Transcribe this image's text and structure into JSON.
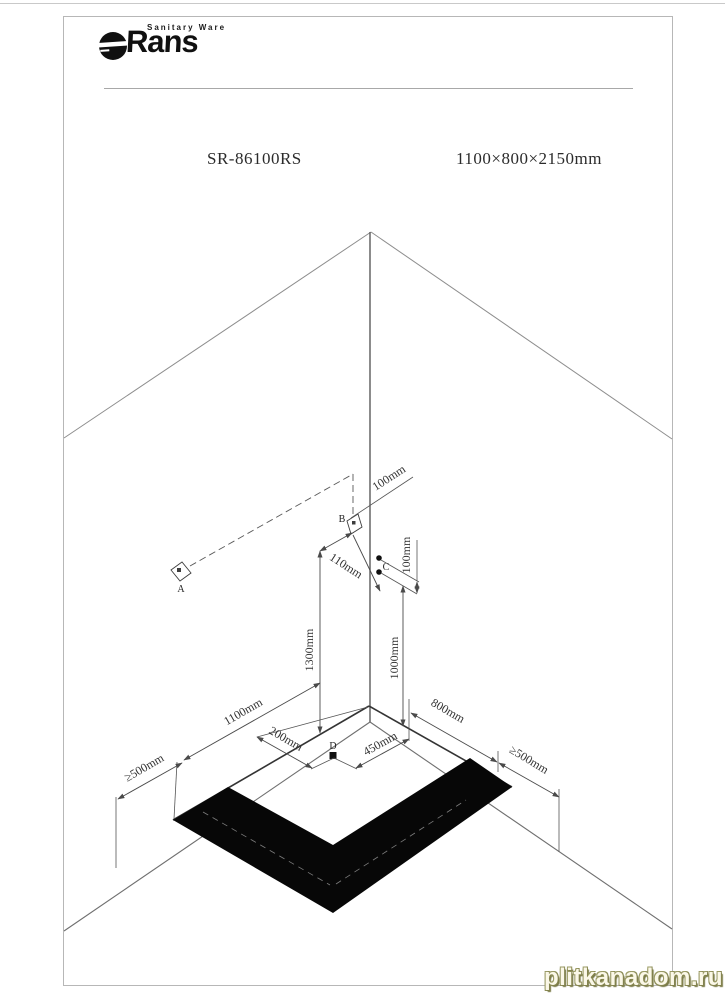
{
  "header": {
    "logo_small_text": "Sanitary Ware",
    "logo_main": "Rans",
    "model": "SR-86100RS",
    "size_spec": "1100×800×2150mm"
  },
  "diagram": {
    "points": {
      "a": "A",
      "b": "B",
      "c": "C",
      "d": "D"
    },
    "dims": {
      "b_from_corner": "100mm",
      "b_offset": "110mm",
      "b_height": "1300mm",
      "c_spacing": "100mm",
      "c_height": "1000mm",
      "floor_left": "1100mm",
      "d_offset_left": "200mm",
      "d_offset_right": "450mm",
      "floor_right": "800mm",
      "clearance_left": "≥500mm",
      "clearance_right": "≥500mm"
    }
  },
  "page": {
    "watermark": "plitkanadom.ru"
  }
}
